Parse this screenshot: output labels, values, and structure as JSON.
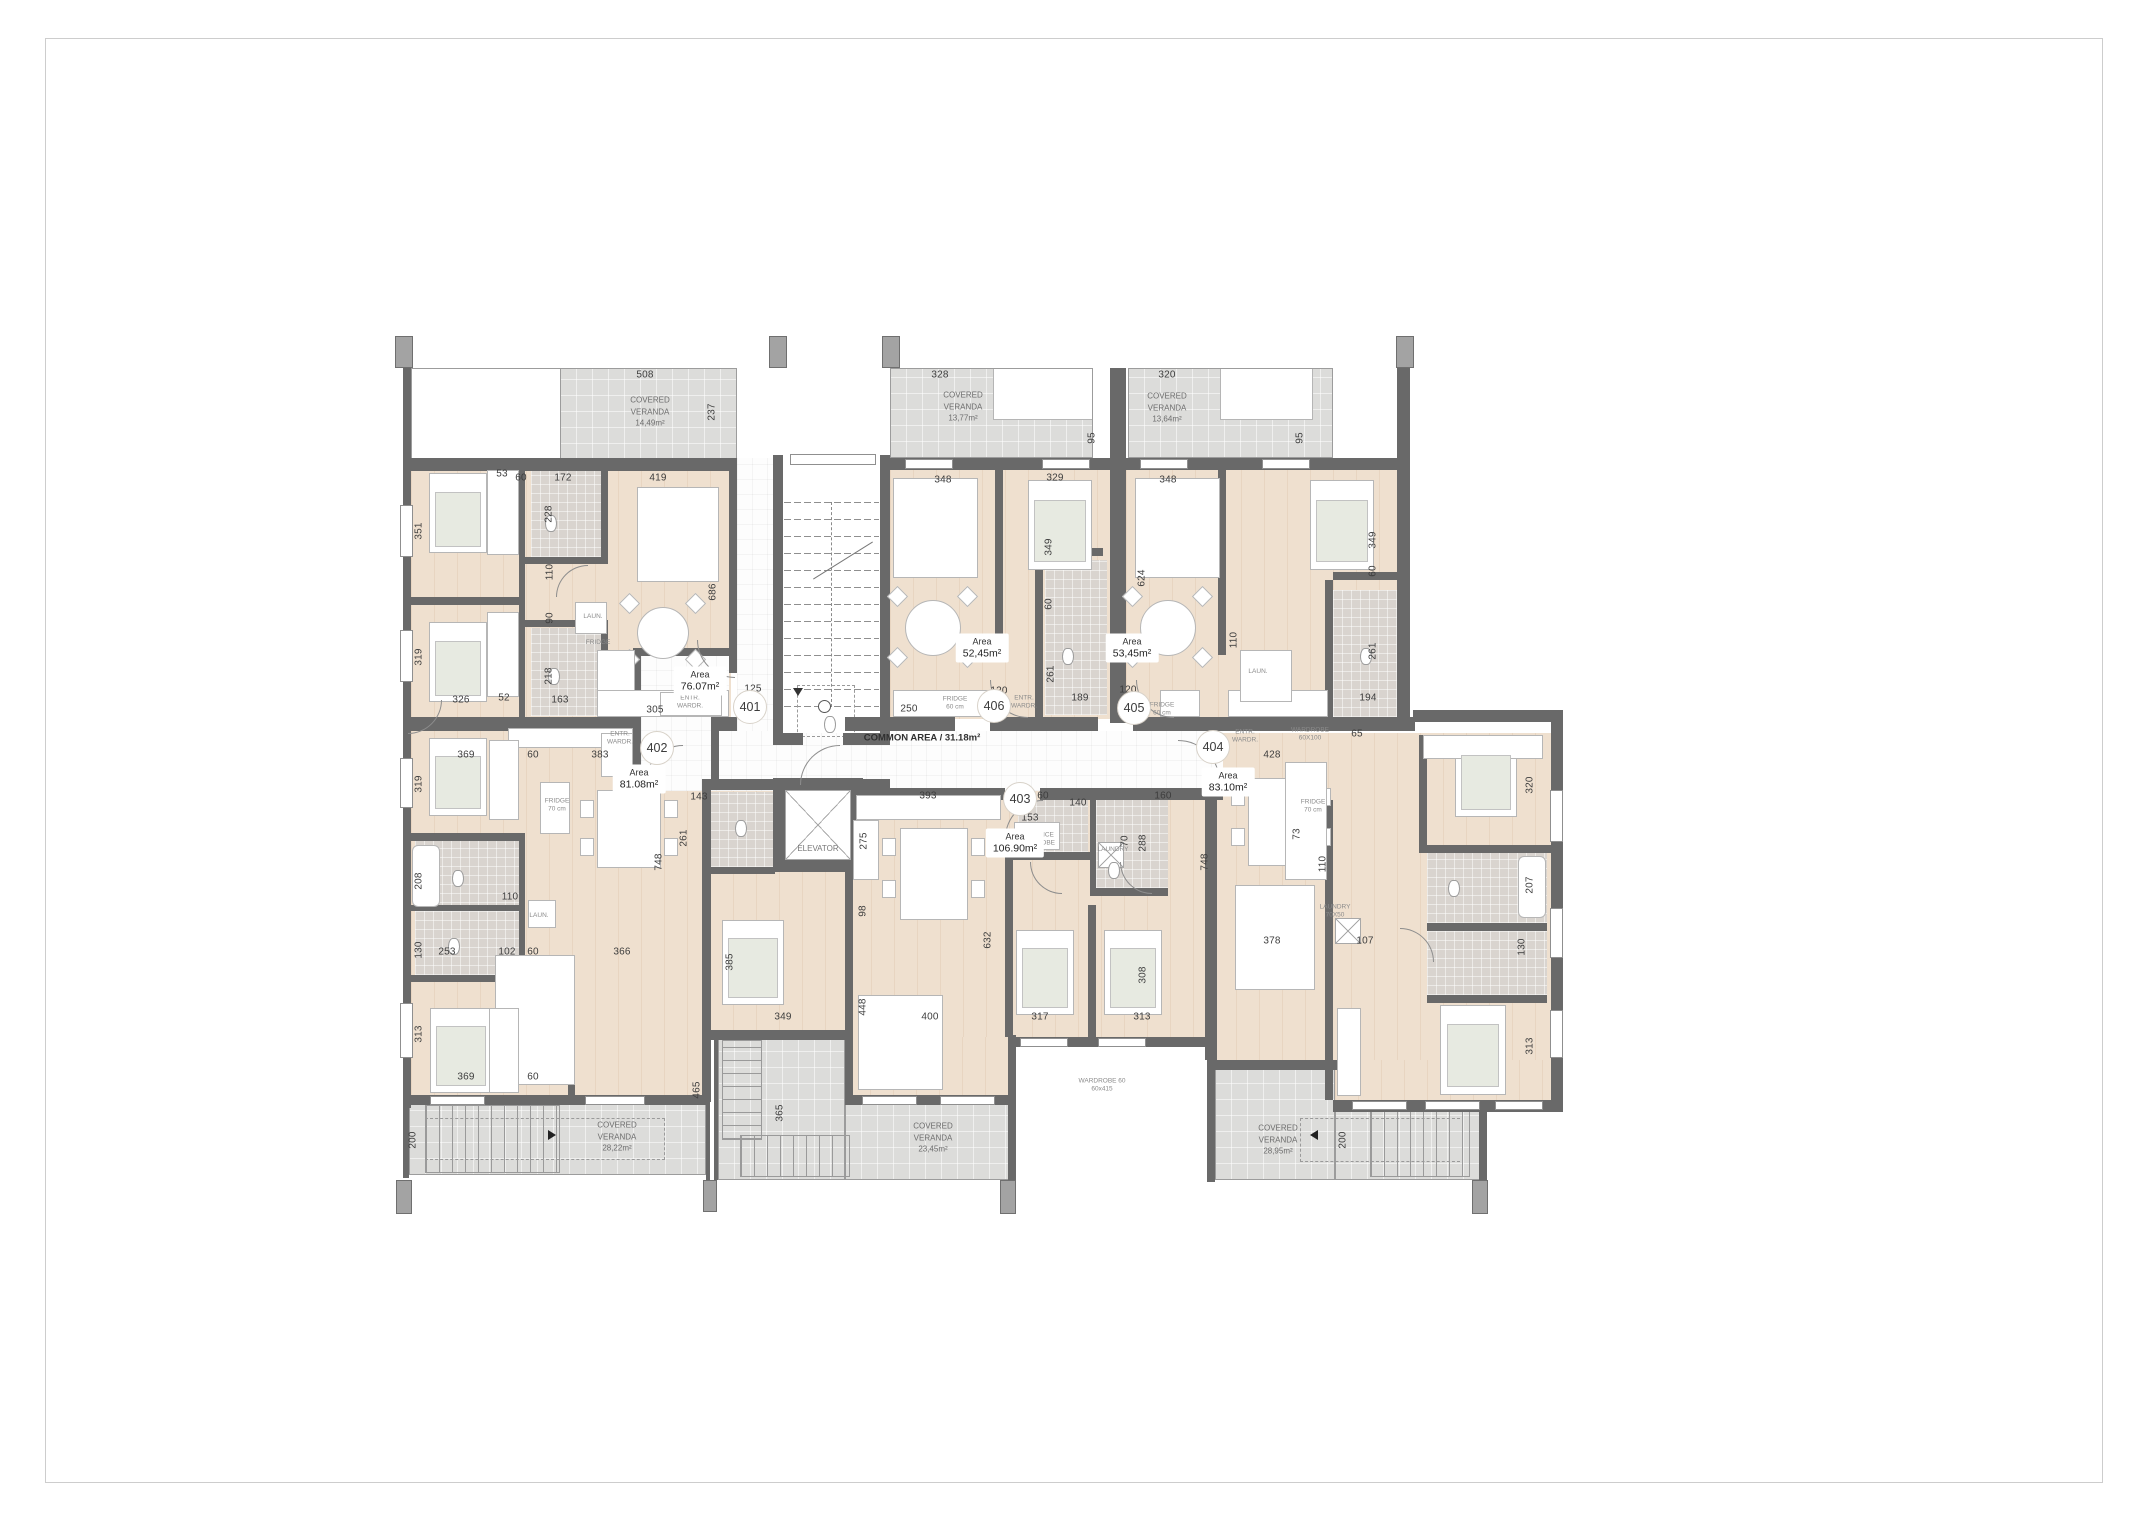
{
  "plan": {
    "common_area_label": "COMMON AREA / 31.18m²",
    "area_word": "Area",
    "veranda_lines": [
      "COVERED",
      "VERANDA"
    ],
    "colors": {
      "wall": "#696969",
      "floor": "#efe0cf",
      "veranda": "#dcdcda",
      "tile": "#d9d4cf"
    },
    "units": [
      {
        "number": "401",
        "x": 750,
        "y": 707
      },
      {
        "number": "402",
        "x": 657,
        "y": 748
      },
      {
        "number": "403",
        "x": 1020,
        "y": 799
      },
      {
        "number": "404",
        "x": 1213,
        "y": 747
      },
      {
        "number": "405",
        "x": 1134,
        "y": 708
      },
      {
        "number": "406",
        "x": 994,
        "y": 706
      }
    ],
    "areas": [
      {
        "unit": "401",
        "value": "76.07m²",
        "x": 700,
        "y": 681
      },
      {
        "unit": "402",
        "value": "81.08m²",
        "x": 639,
        "y": 779
      },
      {
        "unit": "403",
        "value": "106.90m²",
        "x": 1015,
        "y": 843
      },
      {
        "unit": "404",
        "value": "83.10m²",
        "x": 1228,
        "y": 782
      },
      {
        "unit": "405",
        "value": "53,45m²",
        "x": 1132,
        "y": 648
      },
      {
        "unit": "406",
        "value": "52,45m²",
        "x": 982,
        "y": 648
      }
    ],
    "verandas": [
      {
        "value": "14,49m²",
        "x": 650,
        "y": 412
      },
      {
        "value": "13,77m²",
        "x": 963,
        "y": 407
      },
      {
        "value": "13,64m²",
        "x": 1167,
        "y": 408
      },
      {
        "value": "28,22m²",
        "x": 617,
        "y": 1137
      },
      {
        "value": "23,45m²",
        "x": 933,
        "y": 1138
      },
      {
        "value": "28,95m²",
        "x": 1278,
        "y": 1140
      }
    ],
    "dimensions": [
      {
        "t": "508",
        "x": 645,
        "y": 375
      },
      {
        "t": "237",
        "x": 712,
        "y": 412,
        "v": true
      },
      {
        "t": "328",
        "x": 940,
        "y": 375
      },
      {
        "t": "95",
        "x": 1092,
        "y": 438,
        "v": true
      },
      {
        "t": "320",
        "x": 1167,
        "y": 375
      },
      {
        "t": "95",
        "x": 1300,
        "y": 438,
        "v": true
      },
      {
        "t": "60",
        "x": 521,
        "y": 478
      },
      {
        "t": "172",
        "x": 563,
        "y": 478
      },
      {
        "t": "419",
        "x": 658,
        "y": 478
      },
      {
        "t": "53",
        "x": 502,
        "y": 474
      },
      {
        "t": "348",
        "x": 943,
        "y": 480
      },
      {
        "t": "329",
        "x": 1055,
        "y": 478
      },
      {
        "t": "348",
        "x": 1168,
        "y": 480
      },
      {
        "t": "351",
        "x": 419,
        "y": 531,
        "v": true
      },
      {
        "t": "228",
        "x": 549,
        "y": 514,
        "v": true
      },
      {
        "t": "349",
        "x": 1049,
        "y": 547,
        "v": true
      },
      {
        "t": "349",
        "x": 1373,
        "y": 540,
        "v": true
      },
      {
        "t": "110",
        "x": 550,
        "y": 572,
        "v": true
      },
      {
        "t": "60",
        "x": 1049,
        "y": 604,
        "v": true
      },
      {
        "t": "60",
        "x": 1373,
        "y": 571,
        "v": true
      },
      {
        "t": "90",
        "x": 550,
        "y": 618,
        "v": true
      },
      {
        "t": "624",
        "x": 1142,
        "y": 578,
        "v": true
      },
      {
        "t": "686",
        "x": 713,
        "y": 592,
        "v": true
      },
      {
        "t": "319",
        "x": 419,
        "y": 657,
        "v": true
      },
      {
        "t": "218",
        "x": 549,
        "y": 676,
        "v": true
      },
      {
        "t": "261",
        "x": 1051,
        "y": 674,
        "v": true
      },
      {
        "t": "110",
        "x": 1234,
        "y": 640,
        "v": true
      },
      {
        "t": "261",
        "x": 1373,
        "y": 651,
        "v": true
      },
      {
        "t": "326",
        "x": 461,
        "y": 700
      },
      {
        "t": "163",
        "x": 560,
        "y": 700
      },
      {
        "t": "52",
        "x": 504,
        "y": 698
      },
      {
        "t": "305",
        "x": 655,
        "y": 710
      },
      {
        "t": "125",
        "x": 753,
        "y": 689
      },
      {
        "t": "250",
        "x": 909,
        "y": 709
      },
      {
        "t": "120",
        "x": 999,
        "y": 691
      },
      {
        "t": "189",
        "x": 1080,
        "y": 698
      },
      {
        "t": "120",
        "x": 1128,
        "y": 690
      },
      {
        "t": "194",
        "x": 1368,
        "y": 698
      },
      {
        "t": "369",
        "x": 466,
        "y": 755
      },
      {
        "t": "60",
        "x": 533,
        "y": 755
      },
      {
        "t": "383",
        "x": 600,
        "y": 755
      },
      {
        "t": "319",
        "x": 419,
        "y": 784,
        "v": true
      },
      {
        "t": "143",
        "x": 699,
        "y": 797
      },
      {
        "t": "393",
        "x": 928,
        "y": 796
      },
      {
        "t": "428",
        "x": 1272,
        "y": 755
      },
      {
        "t": "65",
        "x": 1357,
        "y": 734
      },
      {
        "t": "60",
        "x": 1043,
        "y": 796
      },
      {
        "t": "140",
        "x": 1078,
        "y": 803
      },
      {
        "t": "160",
        "x": 1163,
        "y": 796
      },
      {
        "t": "153",
        "x": 1030,
        "y": 818
      },
      {
        "t": "208",
        "x": 419,
        "y": 881,
        "v": true
      },
      {
        "t": "261",
        "x": 684,
        "y": 838,
        "v": true
      },
      {
        "t": "275",
        "x": 864,
        "y": 841,
        "v": true
      },
      {
        "t": "73",
        "x": 1297,
        "y": 834,
        "v": true
      },
      {
        "t": "70",
        "x": 1125,
        "y": 841,
        "v": true
      },
      {
        "t": "288",
        "x": 1143,
        "y": 843,
        "v": true
      },
      {
        "t": "110",
        "x": 510,
        "y": 897
      },
      {
        "t": "748",
        "x": 659,
        "y": 862,
        "v": true
      },
      {
        "t": "748",
        "x": 1205,
        "y": 862,
        "v": true
      },
      {
        "t": "110",
        "x": 1323,
        "y": 864,
        "v": true
      },
      {
        "t": "98",
        "x": 863,
        "y": 911,
        "v": true
      },
      {
        "t": "253",
        "x": 447,
        "y": 952
      },
      {
        "t": "130",
        "x": 419,
        "y": 950,
        "v": true
      },
      {
        "t": "102",
        "x": 507,
        "y": 952
      },
      {
        "t": "60",
        "x": 533,
        "y": 952
      },
      {
        "t": "366",
        "x": 622,
        "y": 952
      },
      {
        "t": "378",
        "x": 1272,
        "y": 941
      },
      {
        "t": "107",
        "x": 1365,
        "y": 941
      },
      {
        "t": "320",
        "x": 1530,
        "y": 785,
        "v": true
      },
      {
        "t": "207",
        "x": 1530,
        "y": 885,
        "v": true
      },
      {
        "t": "130",
        "x": 1522,
        "y": 947,
        "v": true
      },
      {
        "t": "632",
        "x": 988,
        "y": 940,
        "v": true
      },
      {
        "t": "308",
        "x": 1143,
        "y": 975,
        "v": true
      },
      {
        "t": "385",
        "x": 730,
        "y": 962,
        "v": true
      },
      {
        "t": "349",
        "x": 783,
        "y": 1017
      },
      {
        "t": "448",
        "x": 863,
        "y": 1007,
        "v": true
      },
      {
        "t": "400",
        "x": 930,
        "y": 1017
      },
      {
        "t": "313",
        "x": 419,
        "y": 1034,
        "v": true
      },
      {
        "t": "317",
        "x": 1040,
        "y": 1017
      },
      {
        "t": "313",
        "x": 1142,
        "y": 1017
      },
      {
        "t": "369",
        "x": 466,
        "y": 1077
      },
      {
        "t": "60",
        "x": 533,
        "y": 1077
      },
      {
        "t": "465",
        "x": 697,
        "y": 1090,
        "v": true
      },
      {
        "t": "365",
        "x": 780,
        "y": 1113,
        "v": true
      },
      {
        "t": "200",
        "x": 413,
        "y": 1140,
        "v": true
      },
      {
        "t": "200",
        "x": 1343,
        "y": 1140,
        "v": true
      },
      {
        "t": "313",
        "x": 1530,
        "y": 1046,
        "v": true
      }
    ],
    "fixtures": [
      {
        "t": "ELEVATOR",
        "x": 818,
        "y": 849,
        "big": true
      },
      {
        "t": "LAUN.",
        "x": 593,
        "y": 617
      },
      {
        "t": "FRIDGE",
        "x": 598,
        "y": 643
      },
      {
        "t": "ENTR.\nWARDR.",
        "x": 690,
        "y": 703
      },
      {
        "t": "ENTR.\nWARDR.",
        "x": 620,
        "y": 739
      },
      {
        "t": "FRIDGE\n70 cm",
        "x": 557,
        "y": 806
      },
      {
        "t": "LAUN.",
        "x": 539,
        "y": 916
      },
      {
        "t": "ENTRANCE\nWARDROBE",
        "x": 1036,
        "y": 840
      },
      {
        "t": "LAUNDRY",
        "x": 1113,
        "y": 850
      },
      {
        "t": "ENTR.\nWARDR.",
        "x": 1024,
        "y": 703
      },
      {
        "t": "FRIDGE\n60 cm",
        "x": 955,
        "y": 704
      },
      {
        "t": "ENTR.\nWARDR.",
        "x": 1245,
        "y": 737
      },
      {
        "t": "FRIDGE\n70 cm",
        "x": 1313,
        "y": 807
      },
      {
        "t": "LAUNDRY\n70X50",
        "x": 1335,
        "y": 912
      },
      {
        "t": "FRIDGE\n60 cm",
        "x": 1162,
        "y": 710
      },
      {
        "t": "LAUN.",
        "x": 1258,
        "y": 672
      },
      {
        "t": "WARDROBE\n60X100",
        "x": 1310,
        "y": 735
      },
      {
        "t": "WARDROBE 60\n60x415",
        "x": 1102,
        "y": 1086
      }
    ]
  }
}
